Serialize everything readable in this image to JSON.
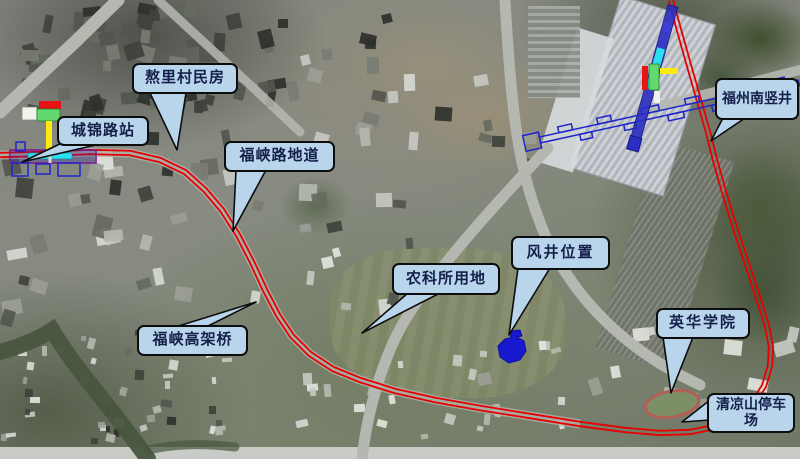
{
  "callouts": [
    {
      "id": "chengjin-road-station",
      "label": "城锦路站"
    },
    {
      "id": "aoli-village-houses",
      "label": "熬里村民房"
    },
    {
      "id": "fuxia-road-underpass",
      "label": "福峡路地道"
    },
    {
      "id": "fuxia-viaduct",
      "label": "福峡高架桥"
    },
    {
      "id": "agri-science-institute-land",
      "label": "农科所用地"
    },
    {
      "id": "vent-shaft-location",
      "label": "风井位置"
    },
    {
      "id": "yinghua-college",
      "label": "英华学院"
    },
    {
      "id": "qingliangshan-depot",
      "label": "清凉山停车场"
    },
    {
      "id": "fuzhou-south-shaft",
      "label": "福州南竖井"
    }
  ],
  "alignment": {
    "style": "double-red-line",
    "color": "#e60000",
    "points": [
      [
        0,
        155
      ],
      [
        40,
        154
      ],
      [
        90,
        152
      ],
      [
        130,
        153
      ],
      [
        160,
        160
      ],
      [
        185,
        172
      ],
      [
        205,
        190
      ],
      [
        222,
        210
      ],
      [
        238,
        235
      ],
      [
        252,
        262
      ],
      [
        265,
        290
      ],
      [
        278,
        315
      ],
      [
        292,
        336
      ],
      [
        310,
        354
      ],
      [
        333,
        369
      ],
      [
        360,
        380
      ],
      [
        395,
        391
      ],
      [
        435,
        400
      ],
      [
        480,
        408
      ],
      [
        530,
        416
      ],
      [
        580,
        424
      ],
      [
        625,
        430
      ],
      [
        660,
        433
      ],
      [
        690,
        432
      ],
      [
        715,
        427
      ],
      [
        737,
        417
      ],
      [
        753,
        403
      ],
      [
        764,
        386
      ],
      [
        770,
        366
      ],
      [
        771,
        347
      ],
      [
        767,
        326
      ],
      [
        758,
        297
      ],
      [
        747,
        264
      ],
      [
        735,
        228
      ],
      [
        724,
        192
      ],
      [
        715,
        160
      ],
      [
        708,
        132
      ],
      [
        698,
        97
      ],
      [
        688,
        62
      ],
      [
        679,
        30
      ],
      [
        673,
        8
      ],
      [
        671,
        0
      ]
    ]
  },
  "colors": {
    "callout_fill": "#b9d5ec",
    "callout_border": "#0d0d0d",
    "callout_text": "#14204a",
    "alignment_red": "#e60000",
    "plan_blue": "#2026c8",
    "vent_shaft_blue": "#1818cf",
    "icon_red": "#e81313",
    "icon_green": "#63d86e",
    "icon_yellow": "#ffe912",
    "icon_cyan": "#29dff0",
    "icon_white": "#f2f2ea"
  }
}
